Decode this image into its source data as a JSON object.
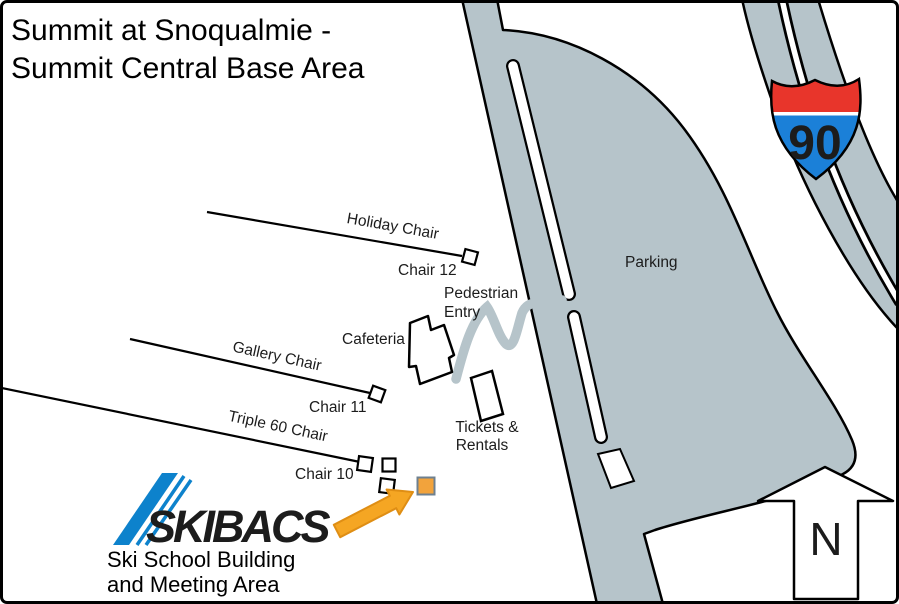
{
  "map_title": {
    "line1": "Summit at Snoqualmie -",
    "line2": "Summit Central Base Area"
  },
  "lifts": [
    {
      "label": "Holiday Chair",
      "station": "Chair 12"
    },
    {
      "label": "Gallery Chair",
      "station": "Chair 11"
    },
    {
      "label": "Triple 60 Chair",
      "station": "Chair 10"
    }
  ],
  "places": {
    "parking": "Parking",
    "cafeteria": "Cafeteria",
    "pedestrian_entry": {
      "line1": "Pedestrian",
      "line2": "Entry"
    },
    "tickets_rentals": {
      "line1": "Tickets &",
      "line2": "Rentals"
    }
  },
  "highway": {
    "shield_number": "90"
  },
  "compass": {
    "north_label": "N"
  },
  "ski_school": {
    "logo_text": "SKIBACS",
    "caption_line1": "Ski School Building",
    "caption_line2": "and Meeting Area"
  },
  "colors": {
    "road_gray": "#B6C4CA",
    "shield_red": "#E8352B",
    "shield_blue": "#1B80D8",
    "logo_blue": "#0D82CC",
    "pointer_orange": "#F5A623",
    "marker_orange": "#F2A33C",
    "marker_orange_border": "#6E8090"
  }
}
